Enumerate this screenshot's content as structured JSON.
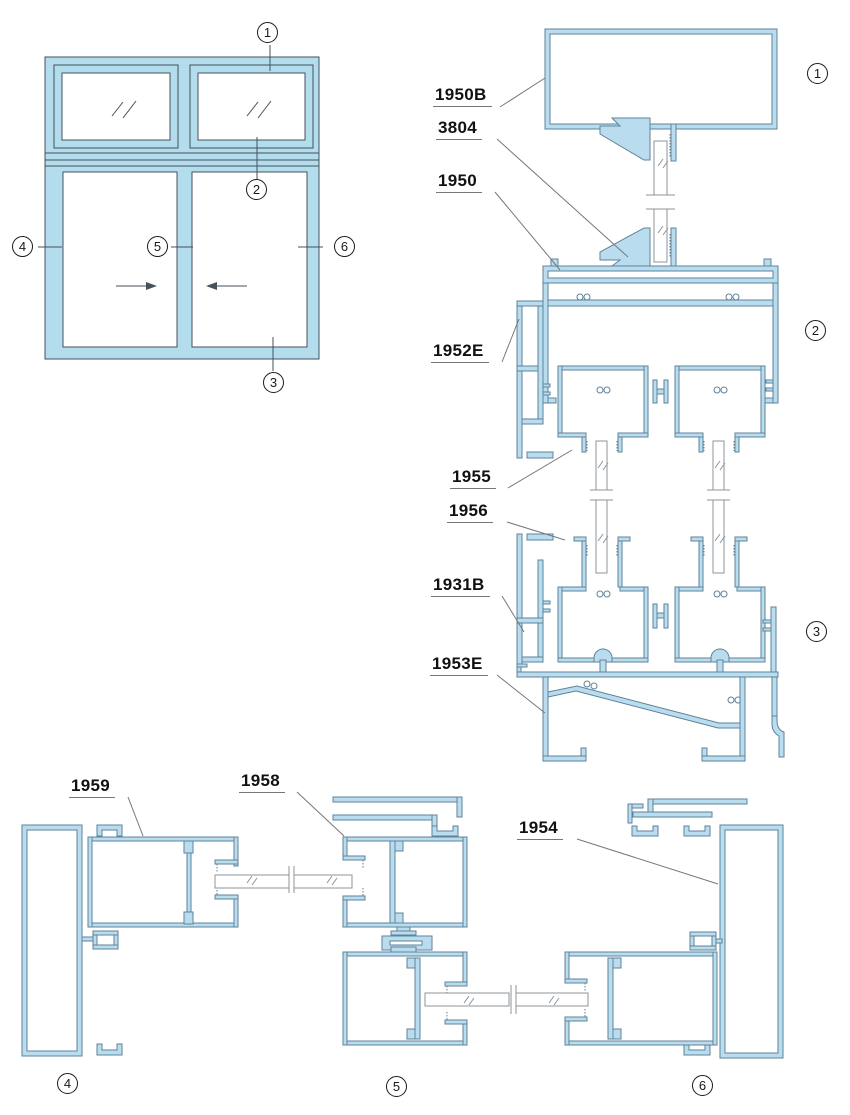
{
  "colors": {
    "profile_fill": "#b9ddee",
    "profile_stroke": "#5f8299",
    "elevation_fill": "#b3dcec",
    "line": "#46525c",
    "glass_line": "#8d9499",
    "leader": "#777777",
    "label_color": "#111111",
    "marker_color": "#1a1a1a"
  },
  "part_labels": [
    {
      "text": "1950B"
    },
    {
      "text": "3804"
    },
    {
      "text": "1950"
    },
    {
      "text": "1952E"
    },
    {
      "text": "1955"
    },
    {
      "text": "1956"
    },
    {
      "text": "1931B"
    },
    {
      "text": "1953E"
    },
    {
      "text": "1959"
    },
    {
      "text": "1958"
    },
    {
      "text": "1954"
    }
  ],
  "elevation_markers": [
    {
      "n": "1"
    },
    {
      "n": "2"
    },
    {
      "n": "3"
    },
    {
      "n": "4"
    },
    {
      "n": "5"
    },
    {
      "n": "6"
    }
  ],
  "detail_markers": [
    {
      "n": "1"
    },
    {
      "n": "2"
    },
    {
      "n": "3"
    },
    {
      "n": "4"
    },
    {
      "n": "5"
    },
    {
      "n": "6"
    }
  ]
}
